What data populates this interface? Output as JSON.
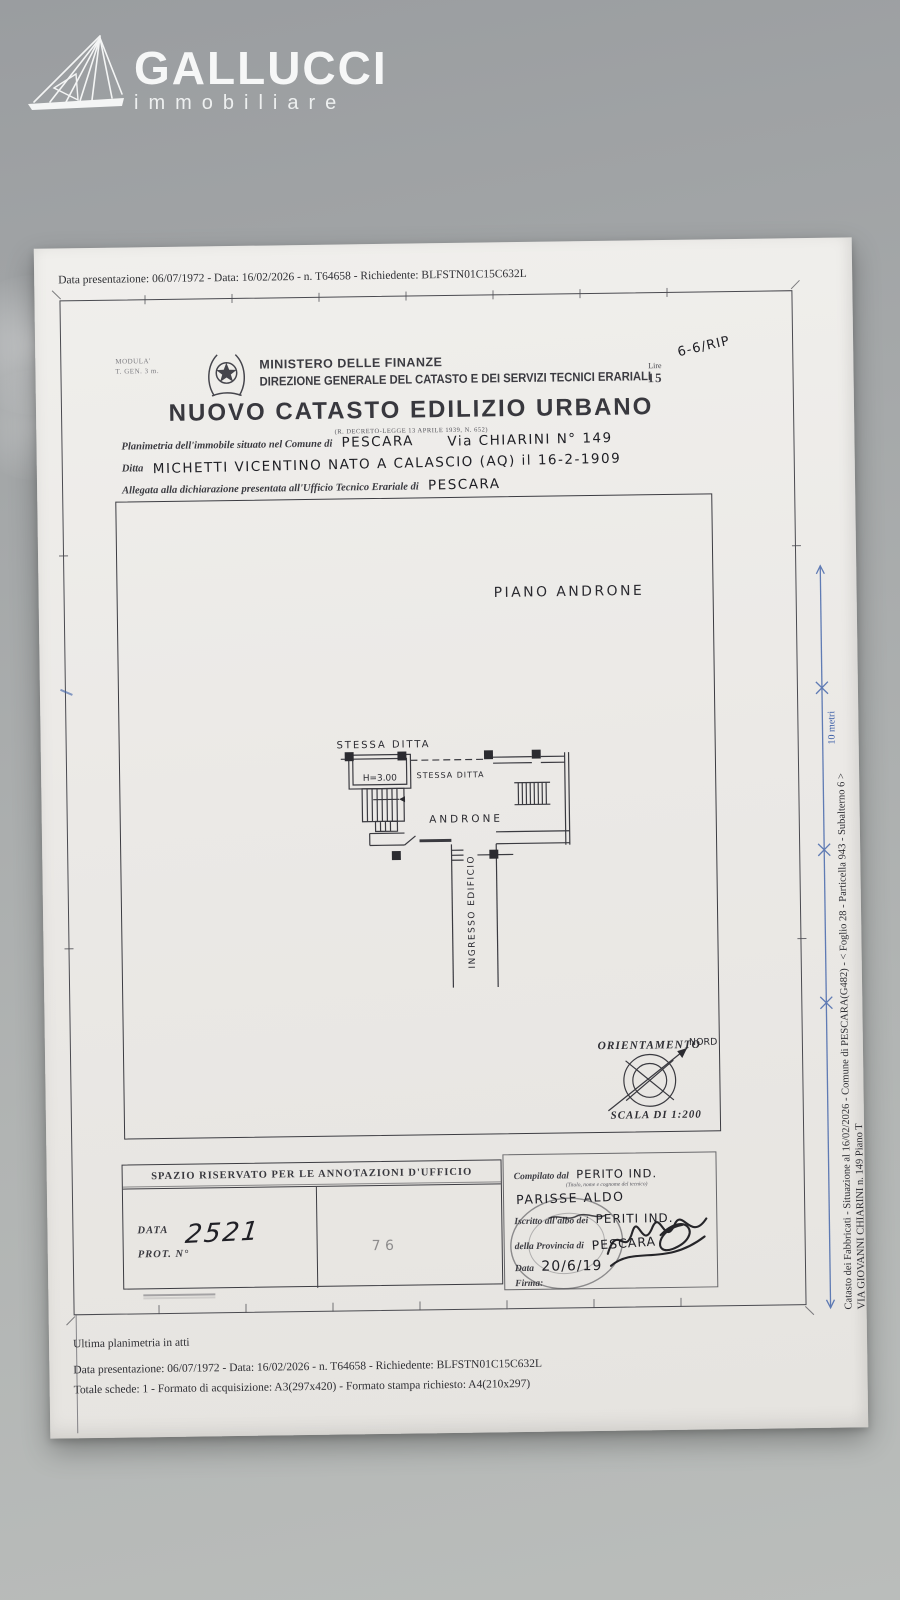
{
  "brand": {
    "name": "GALLUCCI",
    "subtitle": "immobiliare"
  },
  "colors": {
    "background": "#a8abac",
    "paper": "#edebe8",
    "ink": "#34343a",
    "blue_mark": "#3c5fa8",
    "logo_white": "#f4f5f5"
  },
  "document": {
    "top_line": "Data presentazione: 06/07/1972 - Data: 16/02/2026 - n. T64658 - Richiedente: BLFSTN01C15C632L",
    "header": {
      "modula_line1": "MODULA'",
      "modula_line2": "T. GEN. 3 m.",
      "ministry": "MINISTERO DELLE FINANZE",
      "direction": "DIREZIONE GENERALE DEL CATASTO E DEI SERVIZI TECNICI ERARIALI",
      "fee_label": "Lire",
      "fee_value": "15",
      "fee_note_hand": "6-6/RIP",
      "title": "NUOVO CATASTO EDILIZIO URBANO",
      "title_note": "(R. DECRETO-LEGGE 13 APRILE 1939, N. 652)"
    },
    "declaration": {
      "line1_label": "Planimetria dell'immobile situato nel Comune di",
      "line1_value": "PESCARA",
      "line1_value2": "Via CHIARINI N° 149",
      "line2_label": "Ditta",
      "line2_value": "MICHETTI VICENTINO NATO A CALASCIO (AQ) il 16-2-1909",
      "line3_label": "Allegata alla dichiarazione presentata all'Ufficio Tecnico Erariale di",
      "line3_value": "PESCARA"
    },
    "plan": {
      "floor_label": "PIANO ANDRONE",
      "label_stessa_ditta_top": "STESSA DITTA",
      "label_height": "H=3.00",
      "label_stessa_ditta_mid": "STESSA DITTA",
      "label_androne": "ANDRONE",
      "label_ingresso": "INGRESSO EDIFICIO",
      "orientation_title": "ORIENTAMENTO",
      "north_label": "NORD",
      "scale_label": "SCALA DI 1:200"
    },
    "annotations": {
      "header": "SPAZIO RISERVATO PER LE ANNOTAZIONI D'UFFICIO",
      "date_label": "DATA",
      "protocol_label": "PROT. N°",
      "protocol_value": "2521",
      "center_mark": "7 6"
    },
    "compiler": {
      "compiled_by_label": "Compilato dal",
      "compiled_by_value": "PERITO IND.",
      "compiled_by_note": "(Titolo, nome e cognome del tecnico)",
      "name_value": "PARISSE ALDO",
      "registered_label": "Iscritto all'albo dei",
      "registered_value": "PERITI IND.",
      "province_label": "della Provincia di",
      "province_value": "PESCARA",
      "date_label": "Data",
      "date_value": "20/6/19",
      "signature_label": "Firma:"
    },
    "footer": {
      "line1": "Ultima planimetria in atti",
      "line2": "Data presentazione: 06/07/1972 - Data: 16/02/2026 - n. T64658 - Richiedente: BLFSTN01C15C632L",
      "line3": "Totale schede: 1 - Formato di acquisizione: A3(297x420)  - Formato stampa richiesto: A4(210x297)"
    },
    "side": {
      "line1": "Catasto dei Fabbricati - Situazione al 16/02/2026 - Comune di PESCARA(G482) - < Foglio 28 - Particella  943 - Subalterno 6 >",
      "line2": "VIA GIOVANNI CHIARINI n. 149 Piano T",
      "scale_bar_label": "10 metri"
    }
  }
}
